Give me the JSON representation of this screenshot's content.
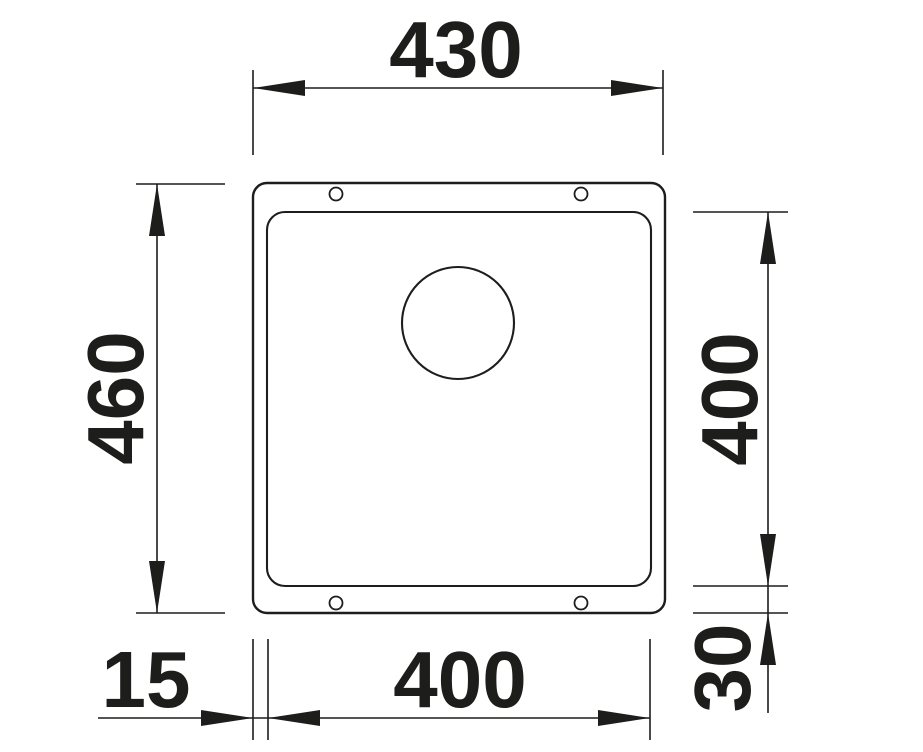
{
  "drawing": {
    "kind": "technical-dimension-drawing",
    "subject": "undermount-sink-top-view",
    "background_color": "#ffffff",
    "ink_color": "#1d1d1b",
    "dimensions": {
      "outer_width": "430",
      "outer_height": "460",
      "bowl_height": "400",
      "bowl_width": "400",
      "rim_offset_left": "15",
      "rim_offset_bottom": "30"
    }
  }
}
